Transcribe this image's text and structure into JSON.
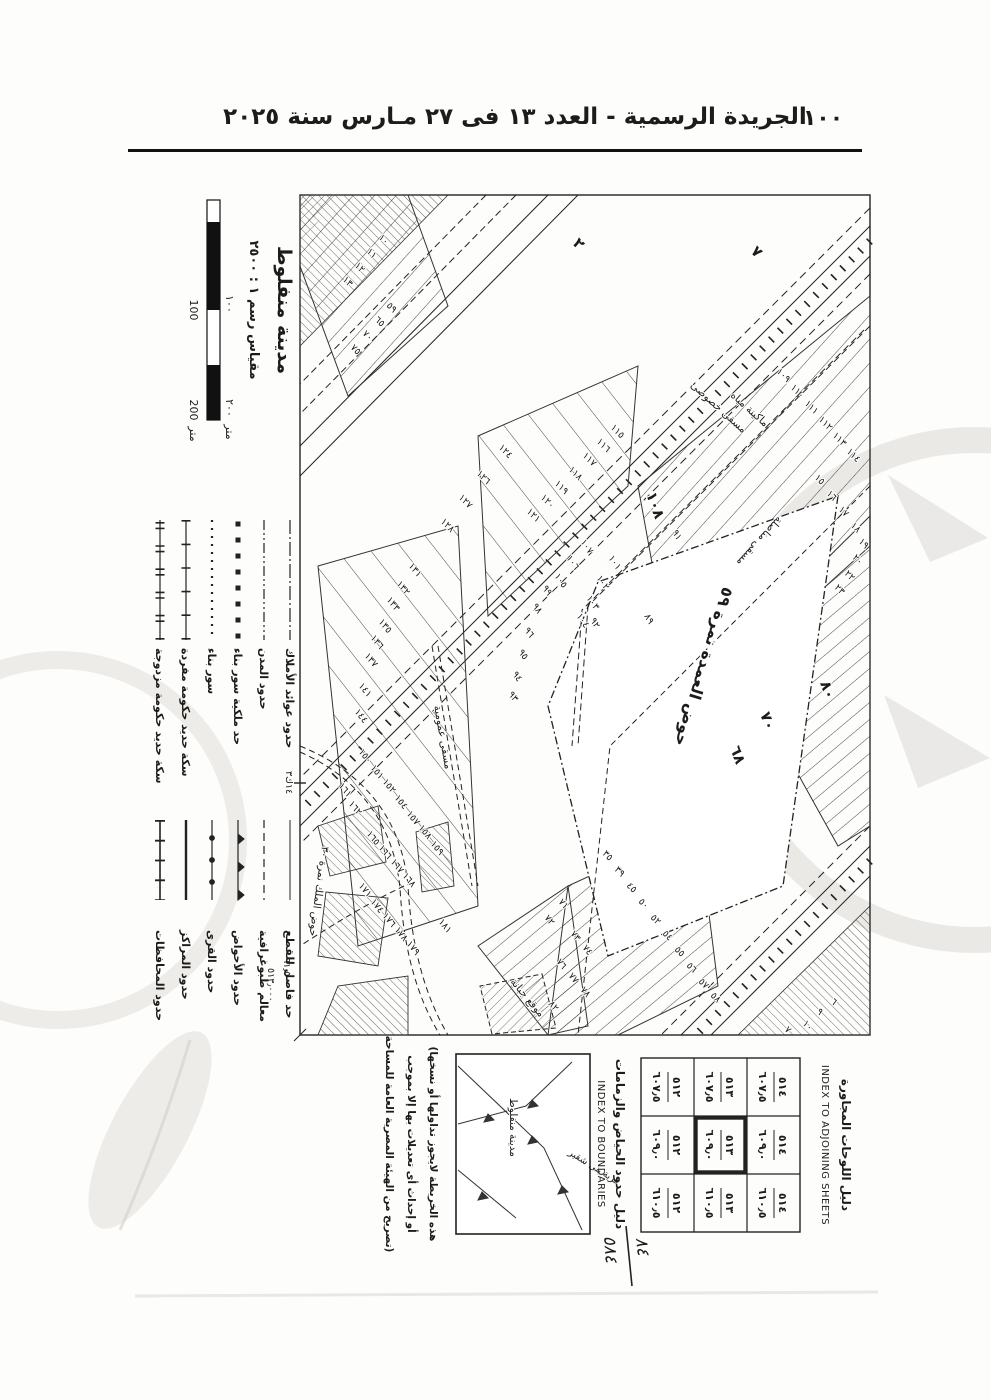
{
  "header": {
    "page_number": "١٠٠",
    "title": "الجريدة الرسمية - العدد ١٣ فى ٢٧ مـارس سنة ٢٠٢٥"
  },
  "sheet": {
    "title": "مدينة منفلوط",
    "scale_label": "مقياس رسم ١ : ٢٥٠٠",
    "scale_bar": {
      "above_100": "١٠٠",
      "above_200": "٢٠٠",
      "above_m": "متر",
      "below_100": "100",
      "below_200": "200",
      "below_m": "متر"
    },
    "legend_group1": {
      "items": [
        {
          "label": "حدود عوائد الأملاك"
        },
        {
          "label": "حدود المدن"
        },
        {
          "label": "حد ملكية سور بناء"
        },
        {
          "label": "سور بناء"
        },
        {
          "label": "سكة حديد حكومة مفردة"
        },
        {
          "label": "سكة حديد حكومة مزدوجة"
        }
      ]
    },
    "legend_group2": {
      "items": [
        {
          "label": "حد فاصل للقطع"
        },
        {
          "label": "معالم طبوغرافية"
        },
        {
          "label": "حدود الأحواض"
        },
        {
          "label": "حدود القرى"
        },
        {
          "label": "حدود المراكز"
        },
        {
          "label": "حدود المحافظات"
        }
      ]
    },
    "adjoining": {
      "title_ar": "دليل اللوحات المجاورة",
      "title_en": "INDEX TO ADJOINING SHEETS",
      "rows": [
        {
          "cells": [
            {
              "num": "٥١٤",
              "den": "٦٠٧٫٥"
            },
            {
              "num": "٥١٤",
              "den": "٦٠٩٫٠"
            },
            {
              "num": "٥١٤",
              "den": "٦١٠٫٥"
            }
          ]
        },
        {
          "cells": [
            {
              "num": "٥١٣",
              "den": "٦٠٧٫٥"
            },
            {
              "num": "٥١٣",
              "den": "٦٠٩٫٠"
            },
            {
              "num": "٥١٣",
              "den": "٦١٠٫٥"
            }
          ]
        },
        {
          "cells": [
            {
              "num": "٥١٢",
              "den": "٦٠٧٫٥"
            },
            {
              "num": "٥١٢",
              "den": "٦٠٩٫٠"
            },
            {
              "num": "٥١٢",
              "den": "٦١٠٫٥"
            }
          ]
        }
      ],
      "current_sheet": {
        "num": "٥١٣",
        "den": "٦٠٩٫٠"
      }
    },
    "handwritten": {
      "top": "٨٤",
      "bottom": "٥٨٤"
    },
    "boundaries": {
      "title_ar": "دليل حدود الحياض والزمامات",
      "title_en": "INDEX TO BOUNDARIES",
      "city_label": "مدينة منفلوط",
      "village_label": "قرية بنى شقير"
    },
    "disclaimer": {
      "line1": "(هذه الخريطة لايجوز تداولها أو نسخها",
      "line2": "أو إحداث أى تعديلات بها إلا بموجب",
      "line3": "تصريح من الهيئة المصرية العامة للمساحة)"
    },
    "map": {
      "hawd_label": "حوض العمدة نمرة ٥٩",
      "hawd_label2": "حوض الملك نمرة ٣٠",
      "cemetery_label": "موقع جبانة",
      "channel1": "مسقى مناصلة",
      "channel2": "مسقى خصوصى",
      "channel3": "ماكينة مياه",
      "channel4": "مسقى عمومية",
      "km_marker": "١٤ك٣",
      "corner_coord_bottom": "٦١٫٥٠٠",
      "corner_coord_right": "٥١٣٫٠٠٠",
      "parcel_labels": [
        {
          "t": "٧",
          "x": 66,
          "y": 128,
          "r": -45,
          "c": "pbig"
        },
        {
          "t": "٢",
          "x": 58,
          "y": 306,
          "r": -45,
          "c": "pbig"
        },
        {
          "t": "٦٨",
          "x": 562,
          "y": 148,
          "r": -20,
          "c": "pbig"
        },
        {
          "t": "٧٠",
          "x": 528,
          "y": 118,
          "r": -20,
          "c": "pbig"
        },
        {
          "t": "٨٠",
          "x": 497,
          "y": 58,
          "r": -20,
          "c": "pbig"
        },
        {
          "t": "١٠٨",
          "x": 308,
          "y": 232,
          "r": -20,
          "c": "pbig"
        },
        {
          "t": "١٠٩",
          "x": 186,
          "y": 102,
          "r": -45
        },
        {
          "t": "١١٠",
          "x": 202,
          "y": 88,
          "r": -45
        },
        {
          "t": "١١١",
          "x": 218,
          "y": 74,
          "r": -45
        },
        {
          "t": "١١٢",
          "x": 234,
          "y": 60,
          "r": -45
        },
        {
          "t": "١١٣",
          "x": 250,
          "y": 46,
          "r": -45
        },
        {
          "t": "١١٤",
          "x": 266,
          "y": 32,
          "r": -45
        },
        {
          "t": "١٥",
          "x": 292,
          "y": 64,
          "r": -45
        },
        {
          "t": "١٦",
          "x": 308,
          "y": 52,
          "r": -45
        },
        {
          "t": "١٧",
          "x": 324,
          "y": 40,
          "r": -45
        },
        {
          "t": "١٨",
          "x": 340,
          "y": 28,
          "r": -45
        },
        {
          "t": "١٩",
          "x": 356,
          "y": 20,
          "r": -45
        },
        {
          "t": "٢٠",
          "x": 372,
          "y": 26,
          "r": -45
        },
        {
          "t": "٢٢",
          "x": 388,
          "y": 34,
          "r": -45
        },
        {
          "t": "٢٣",
          "x": 402,
          "y": 44,
          "r": -45
        },
        {
          "t": "٩١",
          "x": 346,
          "y": 206,
          "r": -30
        },
        {
          "t": "٨٩",
          "x": 430,
          "y": 234,
          "r": -30
        },
        {
          "t": "٩٢",
          "x": 434,
          "y": 288,
          "r": -30
        },
        {
          "t": "٩٣",
          "x": 508,
          "y": 370,
          "r": -35
        },
        {
          "t": "٩٤",
          "x": 488,
          "y": 366,
          "r": -35
        },
        {
          "t": "٩٥",
          "x": 466,
          "y": 360,
          "r": -35
        },
        {
          "t": "٩٦",
          "x": 444,
          "y": 354,
          "r": -35
        },
        {
          "t": "٩٨",
          "x": 420,
          "y": 346,
          "r": -35
        },
        {
          "t": "٩٩",
          "x": 402,
          "y": 336,
          "r": -35
        },
        {
          "t": "١٠٧",
          "x": 356,
          "y": 298,
          "r": -35
        },
        {
          "t": "١٠٦",
          "x": 372,
          "y": 312,
          "r": -35
        },
        {
          "t": "١٠٥",
          "x": 390,
          "y": 324,
          "r": -35
        },
        {
          "t": "١٠١",
          "x": 372,
          "y": 270,
          "r": -35
        },
        {
          "t": "١٠٢",
          "x": 392,
          "y": 282,
          "r": -35
        },
        {
          "t": "١٠٣",
          "x": 412,
          "y": 292,
          "r": -35
        },
        {
          "t": "١٠٤",
          "x": 430,
          "y": 302,
          "r": -35
        },
        {
          "t": "١١٥",
          "x": 242,
          "y": 268,
          "r": -45
        },
        {
          "t": "١١٦",
          "x": 256,
          "y": 282,
          "r": -45
        },
        {
          "t": "١١٧",
          "x": 270,
          "y": 296,
          "r": -45
        },
        {
          "t": "١١٨",
          "x": 284,
          "y": 310,
          "r": -45
        },
        {
          "t": "١١٩",
          "x": 298,
          "y": 324,
          "r": -45
        },
        {
          "t": "١٢٠",
          "x": 312,
          "y": 338,
          "r": -45
        },
        {
          "t": "١٢١",
          "x": 326,
          "y": 352,
          "r": -45
        },
        {
          "t": "١٢٤",
          "x": 262,
          "y": 380,
          "r": -45
        },
        {
          "t": "١٢٦",
          "x": 288,
          "y": 402,
          "r": -45
        },
        {
          "t": "١٢٧",
          "x": 312,
          "y": 420,
          "r": -45
        },
        {
          "t": "١٢٨",
          "x": 336,
          "y": 438,
          "r": -45
        },
        {
          "t": "١٣١",
          "x": 380,
          "y": 470,
          "r": -40
        },
        {
          "t": "١٣٢",
          "x": 398,
          "y": 482,
          "r": -40
        },
        {
          "t": "١٣٣",
          "x": 414,
          "y": 492,
          "r": -40
        },
        {
          "t": "١٣٥",
          "x": 436,
          "y": 500,
          "r": -40
        },
        {
          "t": "١٣٦",
          "x": 452,
          "y": 508,
          "r": -40
        },
        {
          "t": "١٣٧",
          "x": 470,
          "y": 514,
          "r": -40
        },
        {
          "t": "١٤١",
          "x": 500,
          "y": 520,
          "r": -40
        },
        {
          "t": "١٤٤",
          "x": 526,
          "y": 524,
          "r": -40
        },
        {
          "t": "١٥٠",
          "x": 566,
          "y": 520,
          "r": -40
        },
        {
          "t": "١٥١",
          "x": 582,
          "y": 508,
          "r": -40
        },
        {
          "t": "١٥٢",
          "x": 596,
          "y": 496,
          "r": -40
        },
        {
          "t": "١٥٤",
          "x": 612,
          "y": 484,
          "r": -40
        },
        {
          "t": "١٥٧",
          "x": 628,
          "y": 472,
          "r": -40
        },
        {
          "t": "١٥٨",
          "x": 642,
          "y": 460,
          "r": -40
        },
        {
          "t": "١٥٩",
          "x": 658,
          "y": 448,
          "r": -40
        },
        {
          "t": "١٦١",
          "x": 600,
          "y": 540,
          "r": -40
        },
        {
          "t": "١٦٢",
          "x": 618,
          "y": 530,
          "r": -40
        },
        {
          "t": "١٦٥",
          "x": 648,
          "y": 512,
          "r": -40
        },
        {
          "t": "١٦٦",
          "x": 662,
          "y": 500,
          "r": -40
        },
        {
          "t": "١٦٧",
          "x": 676,
          "y": 488,
          "r": -40
        },
        {
          "t": "١٦٨",
          "x": 690,
          "y": 476,
          "r": -40
        },
        {
          "t": "١٧١",
          "x": 700,
          "y": 520,
          "r": -40
        },
        {
          "t": "١٧٤",
          "x": 716,
          "y": 508,
          "r": -40
        },
        {
          "t": "١٧٦",
          "x": 730,
          "y": 496,
          "r": -40
        },
        {
          "t": "١٧٨",
          "x": 744,
          "y": 484,
          "r": -40
        },
        {
          "t": "١٧٩",
          "x": 758,
          "y": 472,
          "r": -40
        },
        {
          "t": "١٨١",
          "x": 736,
          "y": 440,
          "r": -40
        },
        {
          "t": "٣٥",
          "x": 668,
          "y": 276,
          "r": -45
        },
        {
          "t": "٣٩",
          "x": 684,
          "y": 264,
          "r": -45
        },
        {
          "t": "٤٥",
          "x": 700,
          "y": 252,
          "r": -45
        },
        {
          "t": "٥٠",
          "x": 716,
          "y": 240,
          "r": -45
        },
        {
          "t": "٥٢",
          "x": 732,
          "y": 228,
          "r": -45
        },
        {
          "t": "٥٤",
          "x": 748,
          "y": 216,
          "r": -45
        },
        {
          "t": "٥٥",
          "x": 764,
          "y": 204,
          "r": -45
        },
        {
          "t": "٥٦",
          "x": 780,
          "y": 192,
          "r": -45
        },
        {
          "t": "٥٧",
          "x": 796,
          "y": 180,
          "r": -45
        },
        {
          "t": "٥٨",
          "x": 810,
          "y": 168,
          "r": -45
        },
        {
          "t": "٧١",
          "x": 716,
          "y": 320,
          "r": -40
        },
        {
          "t": "٧٢",
          "x": 732,
          "y": 334,
          "r": -40
        },
        {
          "t": "٧٣",
          "x": 748,
          "y": 308,
          "r": -40
        },
        {
          "t": "٧٤",
          "x": 762,
          "y": 296,
          "r": -40
        },
        {
          "t": "٧٦",
          "x": 776,
          "y": 322,
          "r": -40
        },
        {
          "t": "٧٧",
          "x": 790,
          "y": 310,
          "r": -40
        },
        {
          "t": "٧٨",
          "x": 804,
          "y": 298,
          "r": -40
        },
        {
          "t": "٨٢",
          "x": 818,
          "y": 330,
          "r": -40
        },
        {
          "t": "١٠",
          "x": 52,
          "y": 500,
          "r": -45
        },
        {
          "t": "١١",
          "x": 66,
          "y": 512,
          "r": -45
        },
        {
          "t": "١٢",
          "x": 80,
          "y": 524,
          "r": -45
        },
        {
          "t": "١٣",
          "x": 94,
          "y": 536,
          "r": -45
        },
        {
          "t": "٥٩",
          "x": 120,
          "y": 492,
          "r": -45
        },
        {
          "t": "٦٥",
          "x": 134,
          "y": 504,
          "r": -45
        },
        {
          "t": "٧٠",
          "x": 148,
          "y": 516,
          "r": -45
        },
        {
          "t": "٧٥",
          "x": 162,
          "y": 528,
          "r": -45
        },
        {
          "t": "٦",
          "x": 816,
          "y": 48,
          "r": -45
        },
        {
          "t": "٩",
          "x": 826,
          "y": 62,
          "r": -45
        },
        {
          "t": "١٠",
          "x": 838,
          "y": 76,
          "r": -45
        },
        {
          "t": "٧",
          "x": 844,
          "y": 94,
          "r": -45
        }
      ]
    }
  }
}
